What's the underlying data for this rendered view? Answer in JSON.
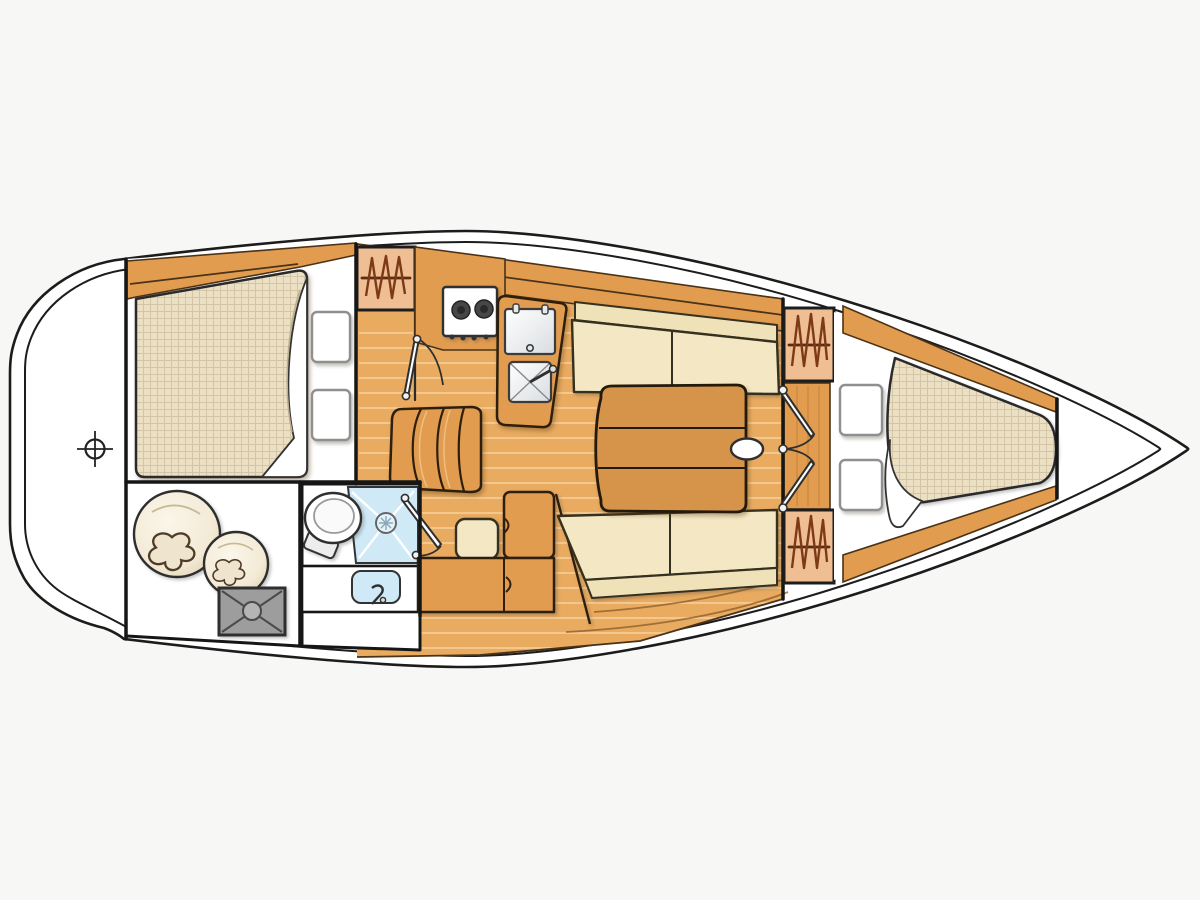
{
  "meta": {
    "title": "Sailboat interior layout floor plan",
    "view": "top-down",
    "bow_direction": "right"
  },
  "colors": {
    "page_bg": "#f7f7f6",
    "hull_fill": "#ffffff",
    "line_dark": "#1c1c1c",
    "wood_floor": "#E8AB60",
    "wood_furniture": "#E19C4F",
    "plank": "#F3C88E",
    "table": "#D6944A",
    "cushion_seat": "#F4E8C4",
    "cushion_back": "#EFE2B8",
    "mattress": "#EBDFC4",
    "locker": "#EFBE92",
    "zigzag": "#7c3a18",
    "shower": "#CFE9F7",
    "gray_hatch": "#9d9d9d",
    "pillow": "#ffffff"
  },
  "features": {
    "cockpit": [
      "steering-position-marker"
    ],
    "aft_cabin": [
      "double-berth",
      "pillow",
      "pillow",
      "shelf-trim"
    ],
    "sail_locker": [
      "sail-bag-large",
      "sail-bag-small",
      "storage-hatch"
    ],
    "head": [
      "toilet",
      "shower-tray",
      "washbasin",
      "door"
    ],
    "galley": [
      "hanging-locker",
      "two-burner-stove",
      "top-loading-icebox",
      "sink",
      "door"
    ],
    "salon": [
      "settee-port",
      "settee-starboard",
      "folding-table",
      "mast-post",
      "companionway-steps",
      "nav-seat",
      "chart-table"
    ],
    "forward_cabin": [
      "hanging-locker",
      "hanging-locker",
      "double-doors",
      "pillow",
      "pillow",
      "v-berth"
    ],
    "bow": [
      "anchor-locker"
    ]
  },
  "counts": {
    "pillows": 4,
    "hanging_lockers": 3,
    "stove_burners": 2,
    "door_leaves": 4,
    "settee_sections": 4
  }
}
